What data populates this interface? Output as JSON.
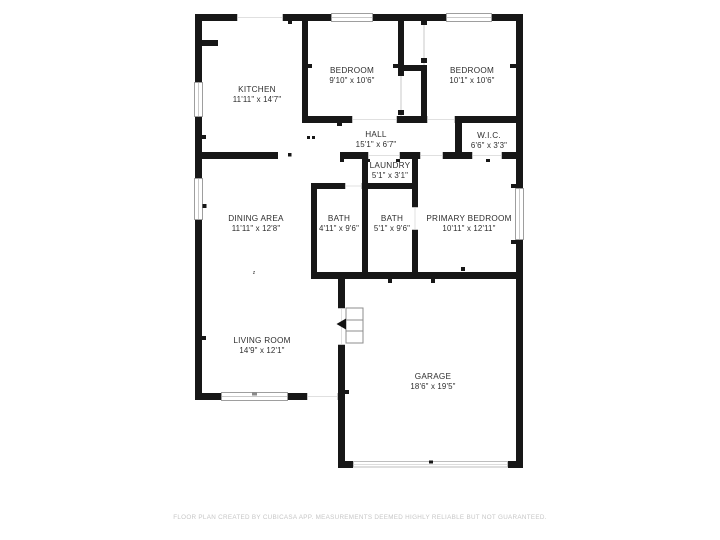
{
  "floorplan": {
    "colors": {
      "wall": "#171717",
      "label_text": "#2e2e2e",
      "window_frame": "#9e9e9e",
      "footer_text": "#c6c6c6",
      "background": "#ffffff"
    },
    "rooms": [
      {
        "name": "KITCHEN",
        "dims": "11'11\" x 14'7\""
      },
      {
        "name": "BEDROOM",
        "dims": "9'10\" x 10'6\""
      },
      {
        "name": "BEDROOM",
        "dims": "10'1\" x 10'6\""
      },
      {
        "name": "HALL",
        "dims": "15'1\" x 6'7\""
      },
      {
        "name": "W.I.C.",
        "dims": "6'6\" x 3'3\""
      },
      {
        "name": "LAUNDRY",
        "dims": "5'1\" x 3'1\""
      },
      {
        "name": "DINING AREA",
        "dims": "11'11\" x 12'8\""
      },
      {
        "name": "BATH",
        "dims": "4'11\" x 9'6\""
      },
      {
        "name": "BATH",
        "dims": "5'1\" x 9'6\""
      },
      {
        "name": "PRIMARY BEDROOM",
        "dims": "10'11\" x 12'11\""
      },
      {
        "name": "LIVING ROOM",
        "dims": "14'9\" x 12'1\""
      },
      {
        "name": "GARAGE",
        "dims": "18'6\" x 19'5\""
      }
    ],
    "marks": {
      "dining_switch": "z"
    },
    "footer": "FLOOR PLAN CREATED BY CUBICASA APP. MEASUREMENTS DEEMED HIGHLY RELIABLE BUT NOT GUARANTEED."
  }
}
